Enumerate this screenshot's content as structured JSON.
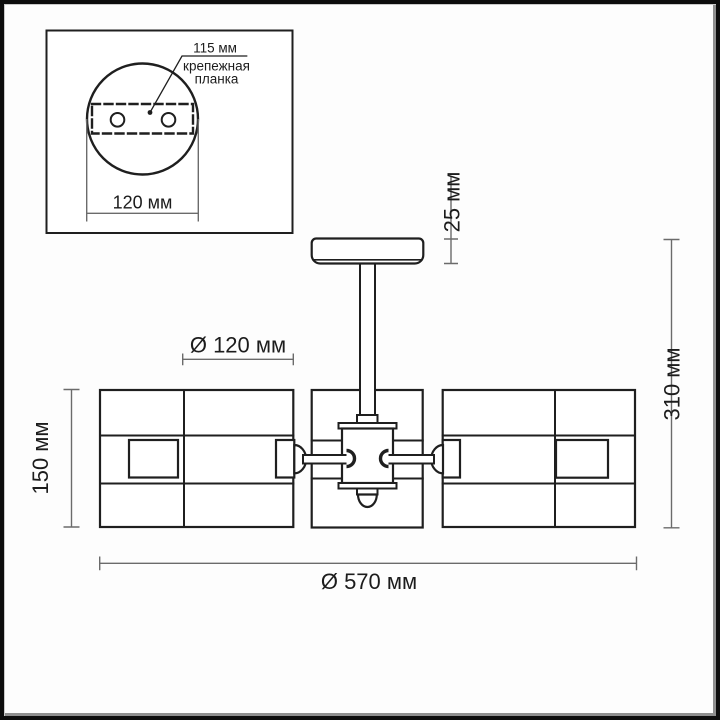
{
  "inset": {
    "hole_pitch_label": "115 мм",
    "bracket_label_line1": "крепежная",
    "bracket_label_line2": "планка",
    "plate_width_label": "120 мм"
  },
  "dimensions": {
    "canopy_height": "25 мм",
    "shade_diameter": "Ø 120 мм",
    "shade_height": "150 мм",
    "total_height": "310 мм",
    "total_diameter": "Ø 570 мм"
  },
  "colors": {
    "line": "#1f1f1f",
    "dimension_line": "#6b6b6b",
    "text": "#1c1c1c",
    "background": "#ffffff",
    "frame": "#0d0d0d"
  }
}
